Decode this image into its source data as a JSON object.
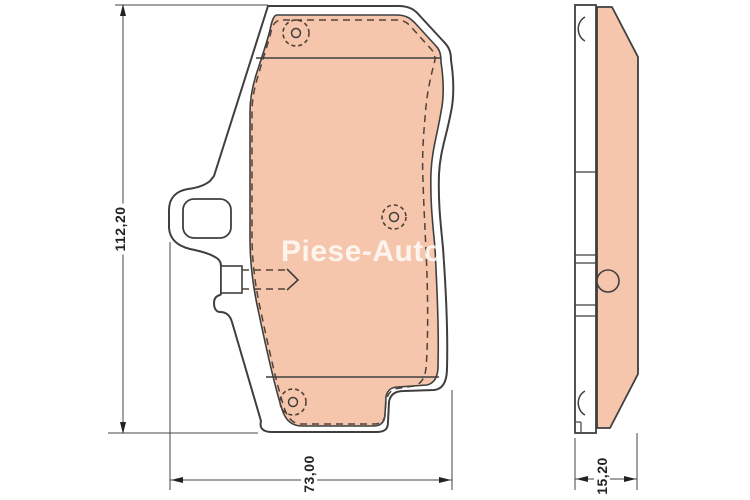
{
  "watermark": {
    "text": "Piese-Auto.co"
  },
  "dimensions": {
    "height_mm": "112,20",
    "width_mm": "73,00",
    "thickness_mm": "15,20"
  },
  "colors": {
    "friction_material": "#f6c6ac",
    "outline": "#3f3f3f",
    "hidden_edge_dashed": "#4e4239",
    "dimension_lines": "#444444",
    "background": "#ffffff",
    "watermark": "rgba(255,255,255,0.8)"
  }
}
